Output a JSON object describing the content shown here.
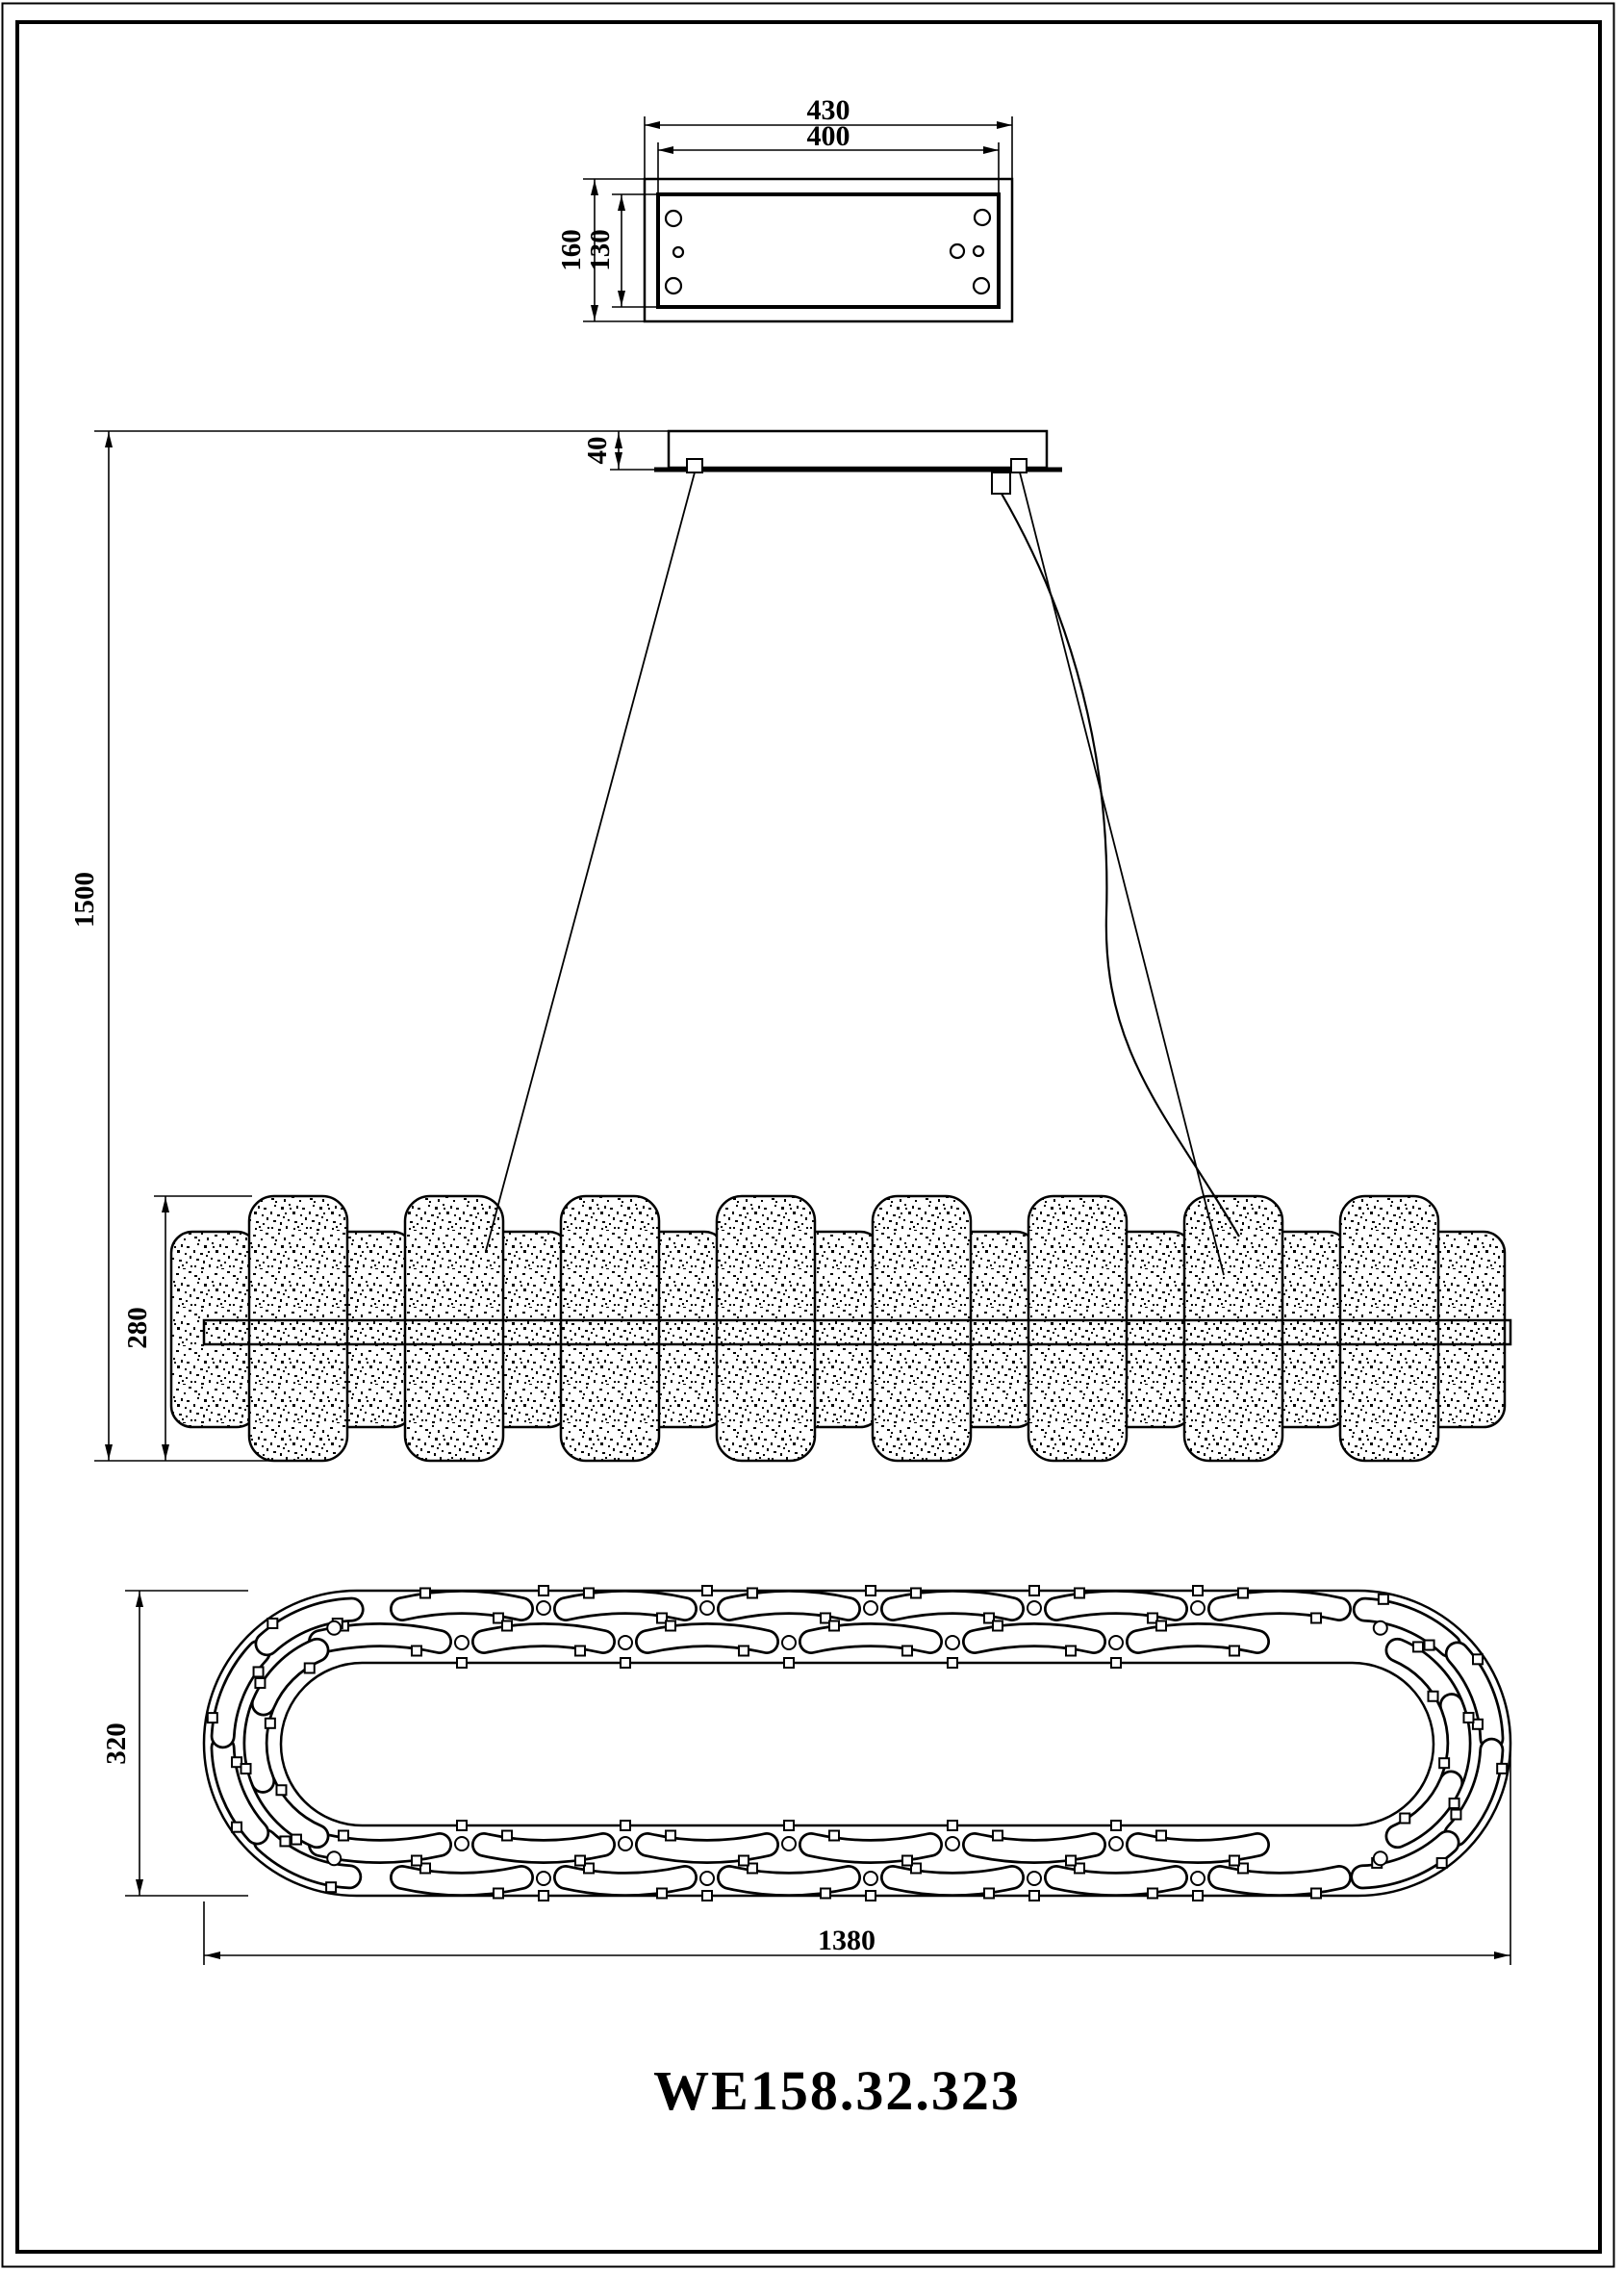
{
  "drawing": {
    "model_number": "WE158.32.323",
    "dimensions": {
      "canopy_width_overall": "430",
      "canopy_width_inner": "400",
      "canopy_depth_overall": "160",
      "canopy_depth_inner": "130",
      "canopy_height": "40",
      "suspension_height": "1500",
      "body_height": "280",
      "body_depth": "320",
      "body_length": "1380"
    }
  }
}
